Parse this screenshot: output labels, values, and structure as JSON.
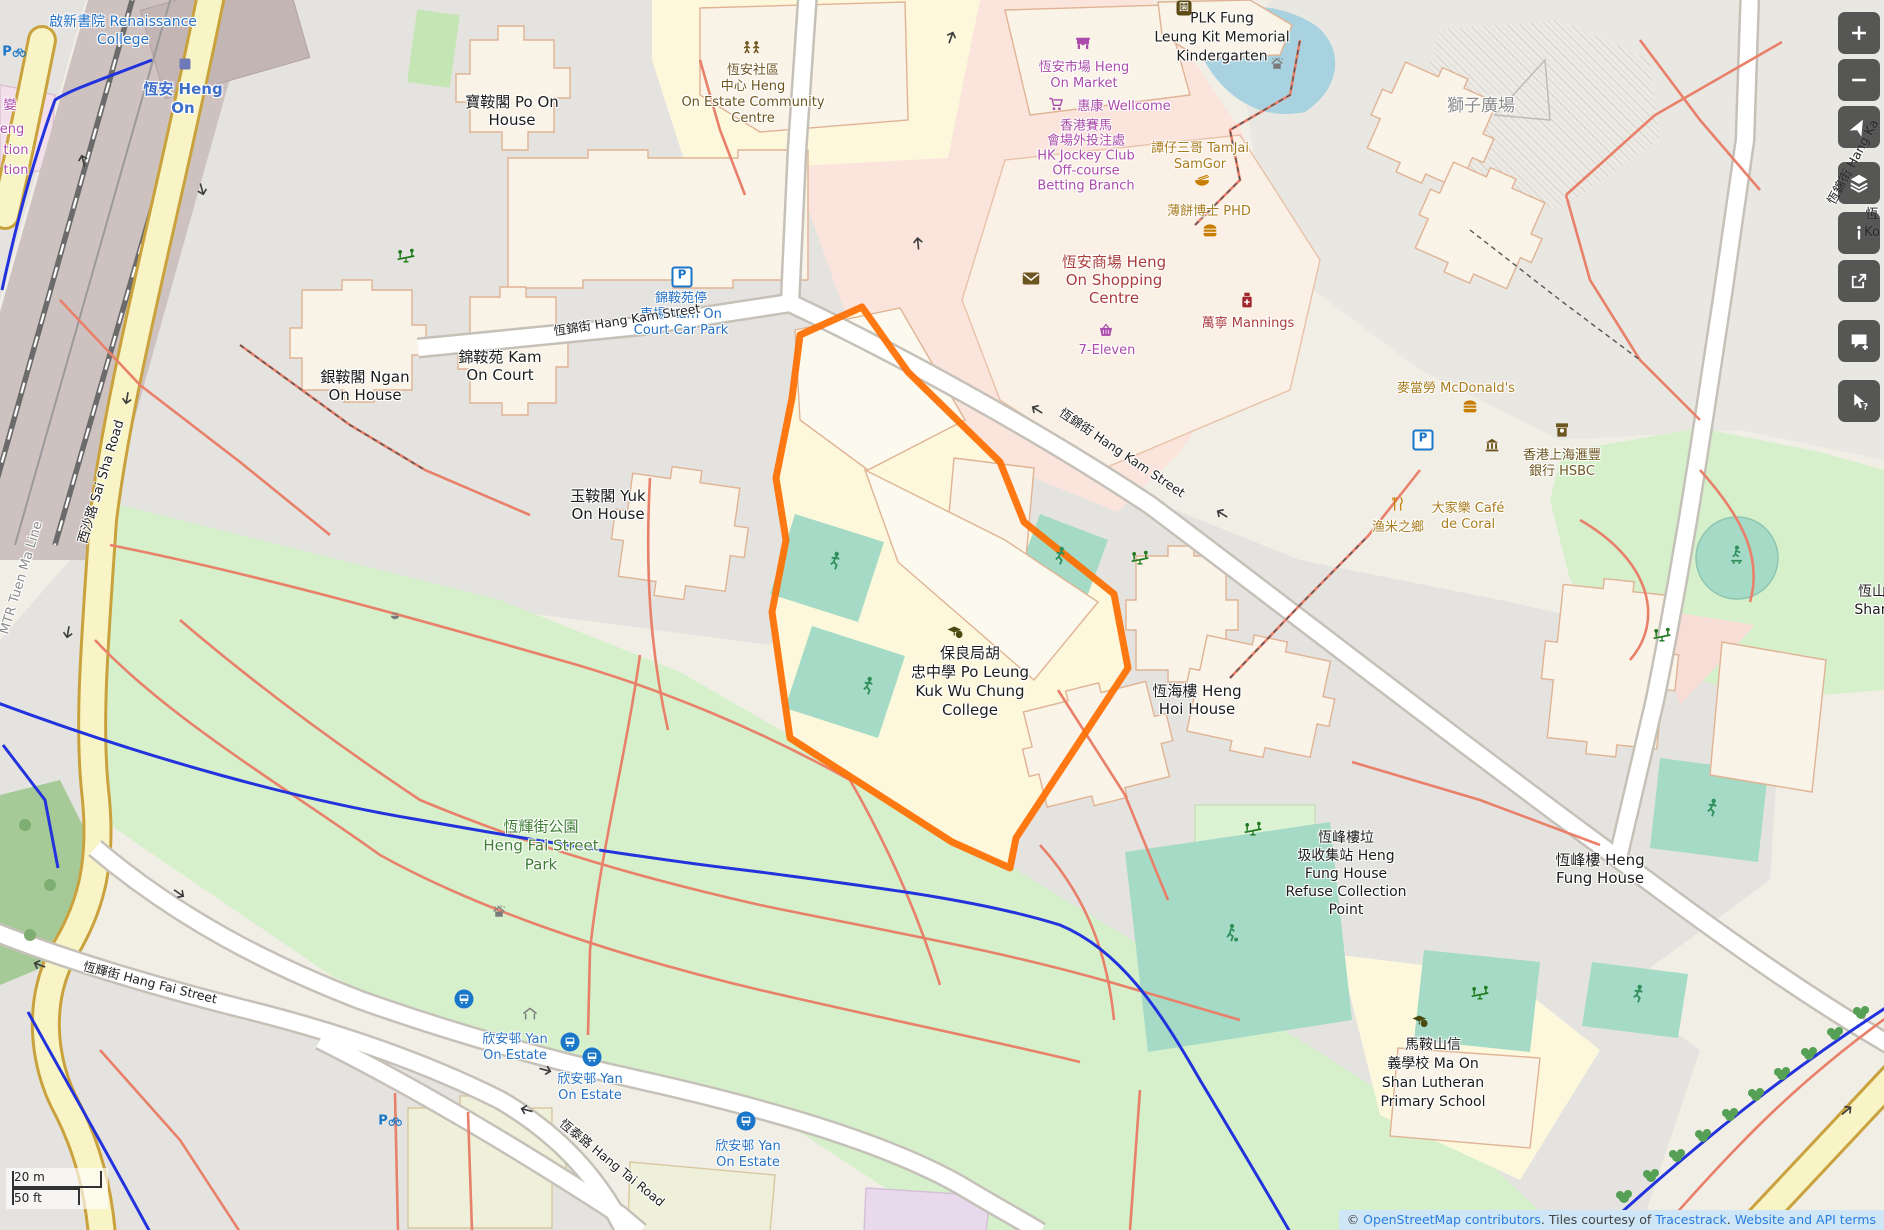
{
  "app": {
    "name": "OpenStreetMap viewer"
  },
  "colors": {
    "selection_orange": "#ff6e00",
    "park_green": "#d6f0cc",
    "pitch_teal": "#a5dbc6",
    "retail_pink": "#fbe4dc",
    "school_yellow": "#fdf8dc",
    "residential_gray": "#e5e3df",
    "water_blue": "#a8d2e0",
    "cycleway_blue": "#2233dd",
    "road_yellow": "#f8f4c5",
    "control_bg": "#2d2d2d",
    "attribution_bg": "#cfe6f6"
  },
  "scalebar": {
    "metric": "20 m",
    "imperial": "50 ft"
  },
  "attribution": {
    "prefix": "© ",
    "link_osm": "OpenStreetMap contributors",
    "mid1": ". Tiles courtesy of ",
    "link_tiles": "Tracestrack",
    "mid2": ". ",
    "link_terms": "Website and API terms"
  },
  "controls": [
    {
      "name": "zoom-in-button",
      "icon": "plus",
      "label": "Zoom in"
    },
    {
      "name": "zoom-out-button",
      "icon": "minus",
      "label": "Zoom out"
    },
    {
      "name": "locate-button",
      "icon": "locate",
      "label": "Show my location"
    },
    {
      "name": "layers-button",
      "icon": "layers",
      "label": "Map layers"
    },
    {
      "name": "map-key-button",
      "icon": "info",
      "label": "Map key"
    },
    {
      "name": "share-button",
      "icon": "share",
      "label": "Share"
    },
    {
      "name": "add-note-button",
      "icon": "note",
      "label": "Add a note"
    },
    {
      "name": "query-features-button",
      "icon": "query",
      "label": "Query features"
    }
  ],
  "map": {
    "labels": [
      {
        "name": "label-renaissance-college",
        "x": 123,
        "y": 31,
        "cls": "blue",
        "fs": 14,
        "lh": 18,
        "lines": [
          "啟新書院 Renaissance",
          "College"
        ]
      },
      {
        "name": "label-heng-on-station",
        "x": 183,
        "y": 99,
        "cls": "station",
        "lh": 19,
        "lines": [
          "恆安 Heng",
          "On"
        ]
      },
      {
        "name": "label-mtr-tuen-ma-line",
        "x": 22,
        "y": 578,
        "rot": -73,
        "cls": "gray",
        "fs": 13,
        "lines": [
          "MTR Tuen Ma Line"
        ]
      },
      {
        "name": "label-sai-sha-road",
        "x": 102,
        "y": 482,
        "rot": -73,
        "cls": "road",
        "fs": 13,
        "lines": [
          "西沙路 Sai Sha Road"
        ]
      },
      {
        "name": "label-po-on-house",
        "x": 512,
        "y": 111,
        "cls": "place",
        "lines": [
          "寶鞍閣 Po On",
          "House"
        ]
      },
      {
        "name": "label-community-centre",
        "x": 753,
        "y": 95,
        "cls": "brown",
        "fs": 13,
        "lh": 16,
        "lines": [
          "恆安社區",
          "中心 Heng",
          "On Estate Community",
          "Centre"
        ]
      },
      {
        "name": "label-kam-on-car-park",
        "x": 681,
        "y": 315,
        "cls": "blue",
        "fs": 13,
        "lh": 16,
        "lines": [
          "錦鞍苑停",
          "車場 Kam On",
          "Court Car Park"
        ]
      },
      {
        "name": "label-ngan-on-house",
        "x": 365,
        "y": 386,
        "cls": "place",
        "lines": [
          "銀鞍閣 Ngan",
          "On House"
        ]
      },
      {
        "name": "label-kam-on-court",
        "x": 500,
        "y": 366,
        "cls": "place",
        "lines": [
          "錦鞍苑 Kam",
          "On Court"
        ]
      },
      {
        "name": "label-yuk-on-house",
        "x": 608,
        "y": 505,
        "cls": "place",
        "lines": [
          "玉鞍閣 Yuk",
          "On House"
        ]
      },
      {
        "name": "label-hang-kam-street-w",
        "x": 627,
        "y": 320,
        "rot": -9,
        "cls": "road",
        "lines": [
          "恆錦街 Hang Kam Street"
        ]
      },
      {
        "name": "label-hang-kam-street-se",
        "x": 1122,
        "y": 453,
        "rot": 34,
        "cls": "road",
        "lines": [
          "恆錦街 Hang Kam Street"
        ]
      },
      {
        "name": "label-hang-kam-street-e",
        "x": 1853,
        "y": 162,
        "rot": -62,
        "cls": "road",
        "lines": [
          "恆錦街 Hang Ka"
        ]
      },
      {
        "name": "label-heng-on-market",
        "x": 1084,
        "y": 76,
        "cls": "purple",
        "lines": [
          "恆安市場 Heng",
          "On Market"
        ]
      },
      {
        "name": "label-wellcome",
        "x": 1124,
        "y": 107,
        "cls": "purple",
        "lines": [
          "惠康 Wellcome"
        ]
      },
      {
        "name": "label-jockey-club",
        "x": 1086,
        "y": 156,
        "cls": "purple",
        "fs": 13,
        "lh": 15,
        "lines": [
          "香港賽馬",
          "會場外投注處",
          "HK Jockey Club",
          "Off-course",
          "Betting Branch"
        ]
      },
      {
        "name": "label-tamjai-samgor",
        "x": 1200,
        "y": 157,
        "cls": "amber",
        "lines": [
          "譚仔三哥 TamJai",
          "SamGor"
        ]
      },
      {
        "name": "label-phd",
        "x": 1209,
        "y": 212,
        "cls": "amber",
        "lines": [
          "薄餅博士 PHD"
        ]
      },
      {
        "name": "label-heng-on-shopping-centre",
        "x": 1114,
        "y": 280,
        "cls": "red",
        "fs": 15,
        "lh": 18,
        "lines": [
          "恆安商場 Heng",
          "On Shopping",
          "Centre"
        ]
      },
      {
        "name": "label-mannings",
        "x": 1248,
        "y": 324,
        "cls": "red",
        "lines": [
          "萬寧 Mannings"
        ]
      },
      {
        "name": "label-7-eleven",
        "x": 1107,
        "y": 351,
        "cls": "purple",
        "lines": [
          "7-Eleven"
        ]
      },
      {
        "name": "label-plk-kindergarten",
        "x": 1222,
        "y": 38,
        "cls": "place",
        "fs": 14,
        "lh": 19,
        "lines": [
          "PLK Fung",
          "Leung Kit Memorial",
          "Kindergarten"
        ]
      },
      {
        "name": "label-lion-square",
        "x": 1481,
        "y": 106,
        "cls": "gray",
        "fs": 17,
        "lines": [
          "獅子廣場"
        ]
      },
      {
        "name": "label-mcdonalds",
        "x": 1456,
        "y": 389,
        "cls": "amber",
        "lines": [
          "麥當勞 McDonald's"
        ]
      },
      {
        "name": "label-hsbc",
        "x": 1562,
        "y": 464,
        "cls": "brown",
        "fs": 13,
        "lh": 16,
        "lines": [
          "香港上海滙豐",
          "銀行 HSBC"
        ]
      },
      {
        "name": "label-yumizhixiang",
        "x": 1398,
        "y": 528,
        "cls": "amber",
        "lines": [
          "渔米之鄉"
        ]
      },
      {
        "name": "label-cafe-de-coral",
        "x": 1468,
        "y": 517,
        "cls": "amber",
        "lines": [
          "大家樂 Café",
          "de Coral"
        ]
      },
      {
        "name": "label-heng-shan-partial",
        "x": 1872,
        "y": 601,
        "cls": "place",
        "fs": 14,
        "lines": [
          "恆山",
          "Shan"
        ]
      },
      {
        "name": "label-heng-ko-partial",
        "x": 1872,
        "y": 224,
        "cls": "place",
        "fs": 13,
        "lines": [
          "恆",
          "Ko"
        ]
      },
      {
        "name": "label-plk-wu-chung-college",
        "x": 970,
        "y": 682,
        "cls": "place",
        "lh": 19,
        "lines": [
          "保良局胡",
          "忠中學 Po Leung",
          "Kuk Wu Chung",
          "College"
        ]
      },
      {
        "name": "label-heng-hoi-house",
        "x": 1197,
        "y": 700,
        "cls": "place",
        "lines": [
          "恆海樓 Heng",
          "Hoi House"
        ]
      },
      {
        "name": "label-refuse-collection-point",
        "x": 1346,
        "y": 874,
        "cls": "place",
        "fs": 14,
        "lh": 18,
        "lines": [
          "恆峰樓垃",
          "圾收集站 Heng",
          "Fung House",
          "Refuse Collection",
          "Point"
        ]
      },
      {
        "name": "label-heng-fung-house",
        "x": 1600,
        "y": 869,
        "cls": "place",
        "lines": [
          "恆峰樓 Heng",
          "Fung House"
        ]
      },
      {
        "name": "label-heng-fai-street-park",
        "x": 541,
        "y": 846,
        "cls": "green",
        "fs": 15,
        "lh": 19,
        "lines": [
          "恆輝街公園",
          "Heng Fai Street",
          "Park"
        ]
      },
      {
        "name": "label-hang-fai-street",
        "x": 150,
        "y": 983,
        "rot": 14,
        "cls": "road",
        "lines": [
          "恆輝街 Hang Fai Street"
        ]
      },
      {
        "name": "label-hang-tai-road",
        "x": 612,
        "y": 1163,
        "rot": 39,
        "cls": "road",
        "lines": [
          "恆泰路 Hang Tai Road"
        ]
      },
      {
        "name": "label-yan-on-estate-1",
        "x": 515,
        "y": 1048,
        "cls": "blue",
        "lines": [
          "欣安邨 Yan",
          "On Estate"
        ]
      },
      {
        "name": "label-yan-on-estate-2",
        "x": 590,
        "y": 1088,
        "cls": "blue",
        "lines": [
          "欣安邨 Yan",
          "On Estate"
        ]
      },
      {
        "name": "label-yan-on-estate-3",
        "x": 748,
        "y": 1155,
        "cls": "blue",
        "lines": [
          "欣安邨 Yan",
          "On Estate"
        ]
      },
      {
        "name": "label-lutheran-school",
        "x": 1433,
        "y": 1074,
        "cls": "place",
        "fs": 14,
        "lh": 19,
        "lines": [
          "馬鞍山信",
          "義學校 Ma On",
          "Shan Lutheran",
          "Primary School"
        ]
      },
      {
        "name": "label-edge-partial-1",
        "x": 10,
        "y": 106,
        "cls": "purple",
        "lines": [
          "變"
        ]
      },
      {
        "name": "label-edge-partial-2",
        "x": 12,
        "y": 130,
        "cls": "purple",
        "lines": [
          "eng"
        ]
      },
      {
        "name": "label-edge-partial-3",
        "x": 16,
        "y": 151,
        "cls": "purple",
        "lines": [
          "tion"
        ]
      },
      {
        "name": "label-edge-partial-4",
        "x": 16,
        "y": 171,
        "cls": "purple",
        "lines": [
          "tion"
        ]
      }
    ],
    "icons": [
      {
        "name": "station-icon",
        "type": "station",
        "x": 185,
        "y": 64
      },
      {
        "name": "bicycle-parking-icon",
        "type": "bikep",
        "x": 14,
        "y": 52
      },
      {
        "name": "bicycle-parking-icon",
        "type": "bikep",
        "x": 390,
        "y": 1121
      },
      {
        "name": "community-centre-icon",
        "type": "people",
        "x": 752,
        "y": 50,
        "c": "#6d5520"
      },
      {
        "name": "parking-icon",
        "type": "parking",
        "x": 682,
        "y": 277
      },
      {
        "name": "parking-icon",
        "type": "parking",
        "x": 1423,
        "y": 440
      },
      {
        "name": "marketplace-icon",
        "type": "market",
        "x": 1083,
        "y": 45
      },
      {
        "name": "supermarket-cart-icon",
        "type": "cart",
        "x": 1056,
        "y": 106
      },
      {
        "name": "noodle-bowl-icon",
        "type": "bowl",
        "x": 1202,
        "y": 183
      },
      {
        "name": "fast-food-icon",
        "type": "burger",
        "x": 1210,
        "y": 231
      },
      {
        "name": "fast-food-icon",
        "type": "burger",
        "x": 1470,
        "y": 407
      },
      {
        "name": "post-office-icon",
        "type": "mail",
        "x": 1031,
        "y": 280
      },
      {
        "name": "pharmacy-icon",
        "type": "pills",
        "x": 1247,
        "y": 302
      },
      {
        "name": "convenience-basket-icon",
        "type": "basket",
        "x": 1106,
        "y": 332
      },
      {
        "name": "kindergarten-icon",
        "type": "kg",
        "x": 1184,
        "y": 8
      },
      {
        "name": "bank-icon",
        "type": "bank",
        "x": 1492,
        "y": 446
      },
      {
        "name": "atm-icon",
        "type": "atm",
        "x": 1562,
        "y": 432
      },
      {
        "name": "restaurant-icon",
        "type": "cutlery",
        "x": 1398,
        "y": 506
      },
      {
        "name": "school-icon",
        "type": "school",
        "x": 955,
        "y": 633
      },
      {
        "name": "school-icon",
        "type": "school",
        "x": 1420,
        "y": 1022
      },
      {
        "name": "pitch-runner-icon",
        "type": "runner",
        "x": 835,
        "y": 563
      },
      {
        "name": "pitch-runner-icon",
        "type": "runner",
        "x": 868,
        "y": 688
      },
      {
        "name": "pitch-runner-icon",
        "type": "runner",
        "x": 1060,
        "y": 558
      },
      {
        "name": "pitch-runner-icon",
        "type": "runner",
        "x": 1712,
        "y": 810
      },
      {
        "name": "pitch-runner-icon",
        "type": "runner",
        "x": 1638,
        "y": 996
      },
      {
        "name": "football-pitch-icon",
        "type": "soccer",
        "x": 1232,
        "y": 935
      },
      {
        "name": "skatepark-icon",
        "type": "skate",
        "x": 1737,
        "y": 557
      },
      {
        "name": "playground-icon",
        "type": "seesaw",
        "x": 406,
        "y": 258
      },
      {
        "name": "playground-icon",
        "type": "seesaw",
        "x": 1140,
        "y": 560
      },
      {
        "name": "playground-icon",
        "type": "seesaw",
        "x": 1253,
        "y": 831
      },
      {
        "name": "playground-icon",
        "type": "seesaw",
        "x": 1480,
        "y": 995
      },
      {
        "name": "playground-icon",
        "type": "seesaw",
        "x": 1662,
        "y": 637
      },
      {
        "name": "fountain-icon",
        "type": "fountain",
        "x": 395,
        "y": 616
      },
      {
        "name": "shower-icon",
        "type": "shower",
        "x": 499,
        "y": 913
      },
      {
        "name": "shower-icon",
        "type": "shower",
        "x": 1277,
        "y": 65
      },
      {
        "name": "shelter-icon",
        "type": "shelter",
        "x": 530,
        "y": 1015
      },
      {
        "name": "bus-stop-icon",
        "type": "bus",
        "x": 464,
        "y": 999
      },
      {
        "name": "bus-stop-icon",
        "type": "bus",
        "x": 570,
        "y": 1042
      },
      {
        "name": "bus-stop-icon",
        "type": "bus",
        "x": 592,
        "y": 1057
      },
      {
        "name": "bus-stop-icon",
        "type": "bus",
        "x": 746,
        "y": 1121
      },
      {
        "name": "oneway-arrow-icon",
        "type": "arrow",
        "x": 85,
        "y": 160,
        "rot": -105
      },
      {
        "name": "oneway-arrow-icon",
        "type": "arrow",
        "x": 200,
        "y": 190,
        "rot": 75
      },
      {
        "name": "oneway-arrow-icon",
        "type": "arrow",
        "x": 125,
        "y": 398,
        "rot": 100
      },
      {
        "name": "oneway-arrow-icon",
        "type": "arrow",
        "x": 66,
        "y": 632,
        "rot": 100
      },
      {
        "name": "oneway-arrow-icon",
        "type": "arrow",
        "x": 953,
        "y": 38,
        "rot": -70
      },
      {
        "name": "oneway-arrow-icon",
        "type": "arrow",
        "x": 920,
        "y": 243,
        "rot": -95
      },
      {
        "name": "oneway-arrow-icon",
        "type": "arrow",
        "x": 1038,
        "y": 408,
        "rot": 212
      },
      {
        "name": "oneway-arrow-icon",
        "type": "arrow",
        "x": 1223,
        "y": 512,
        "rot": 212
      },
      {
        "name": "oneway-arrow-icon",
        "type": "arrow",
        "x": 545,
        "y": 1072,
        "rot": 15
      },
      {
        "name": "oneway-arrow-icon",
        "type": "arrow",
        "x": 527,
        "y": 1108,
        "rot": 195
      },
      {
        "name": "oneway-arrow-icon",
        "type": "arrow",
        "x": 178,
        "y": 895,
        "rot": 35
      },
      {
        "name": "oneway-arrow-icon",
        "type": "arrow",
        "x": 40,
        "y": 963,
        "rot": 200
      },
      {
        "name": "oneway-arrow-icon",
        "type": "arrow",
        "x": 1848,
        "y": 1112,
        "rot": -40
      }
    ]
  }
}
